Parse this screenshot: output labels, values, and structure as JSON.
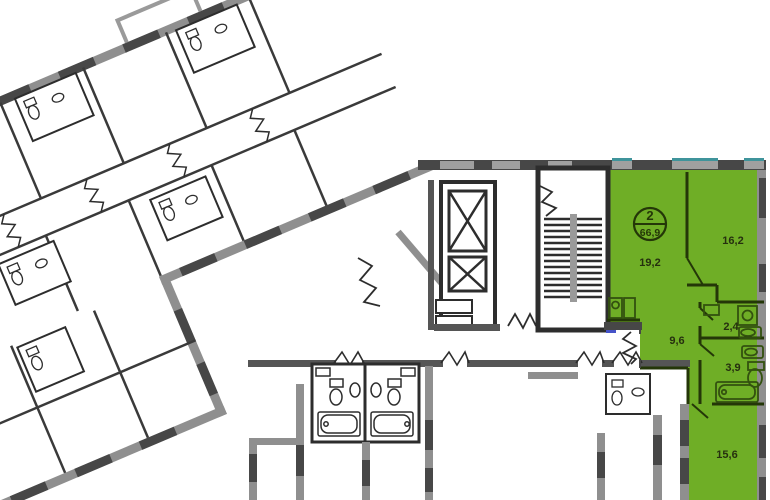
{
  "floorplan": {
    "badge": {
      "rooms": "2",
      "area": "66,9"
    },
    "room_areas": [
      {
        "label": "19,2"
      },
      {
        "label": "16,2"
      },
      {
        "label": "2,4"
      },
      {
        "label": "9,6"
      },
      {
        "label": "3,9"
      },
      {
        "label": "15,6"
      }
    ],
    "colors": {
      "highlight_green": "#6FAE26",
      "green_wall_dark": "#243708",
      "green_fixture": "#33510f",
      "wall_gray": "#8F8F8F",
      "wall_window_dark": "#474747",
      "wall_outline_dark": "#2D2D2D",
      "glazing_teal": "#3F949B",
      "door_mark_blue": "#4553c8"
    }
  }
}
